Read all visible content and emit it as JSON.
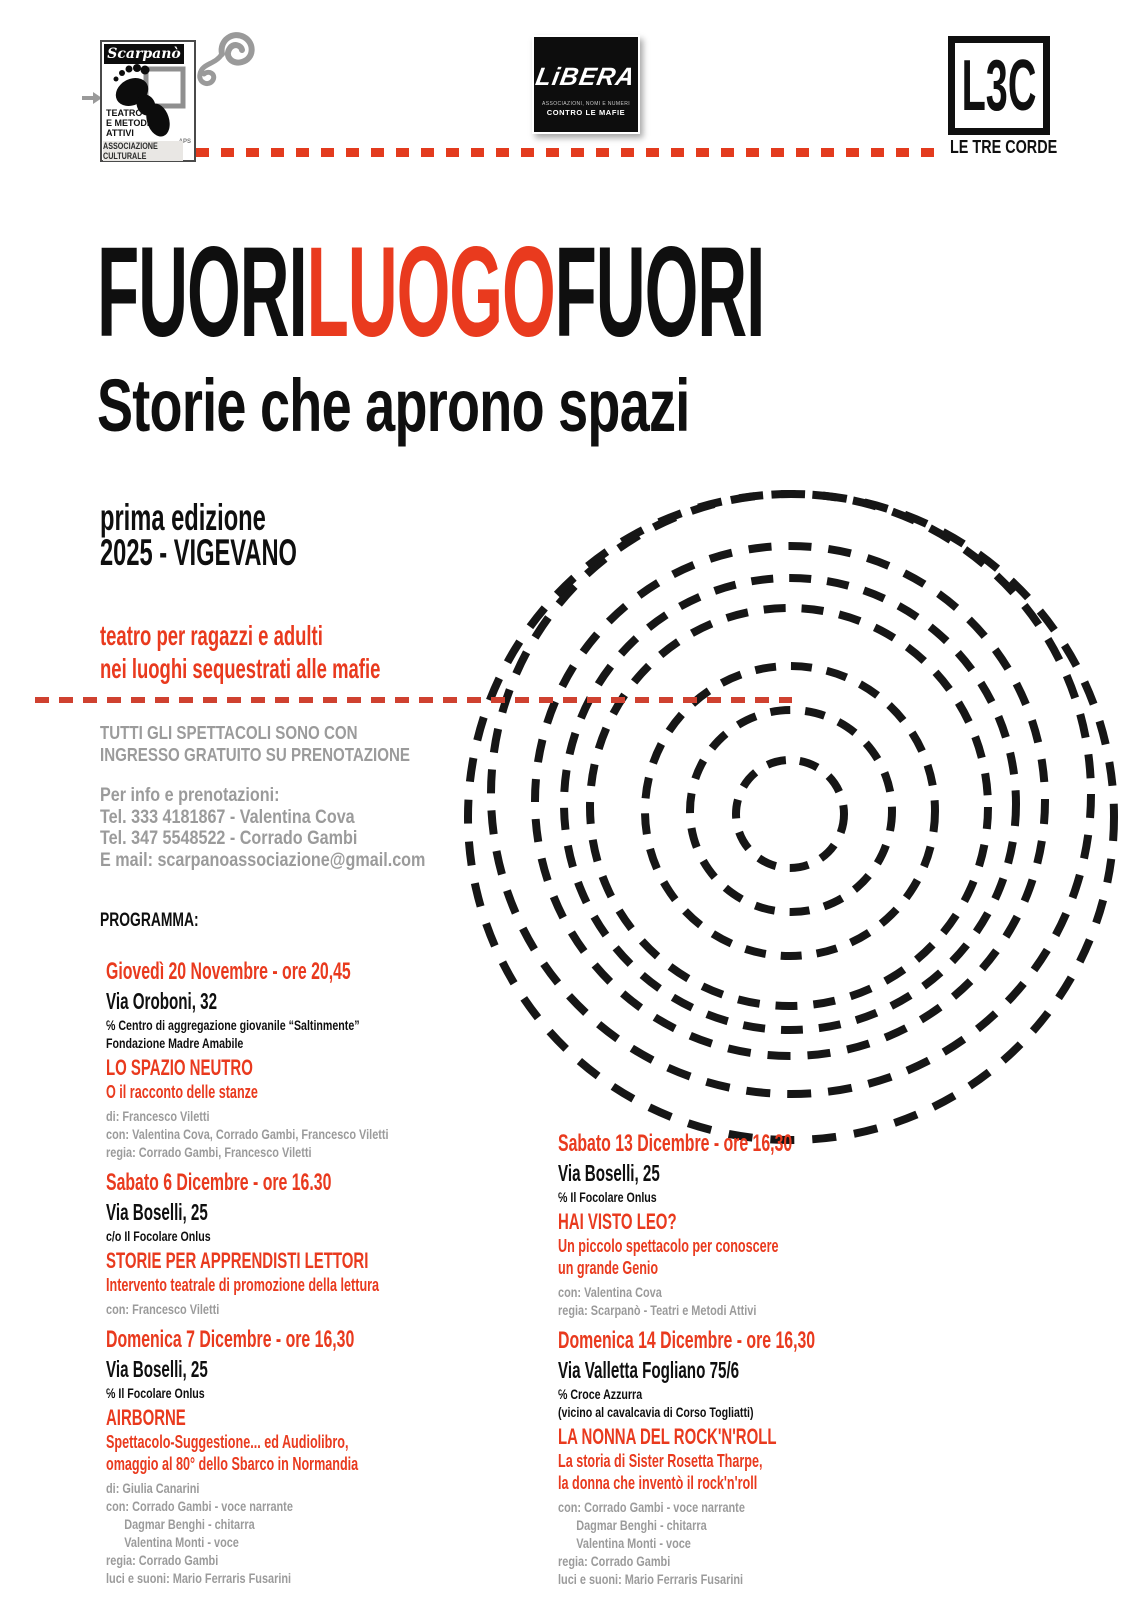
{
  "colors": {
    "accent_red": "#e93a1e",
    "text_gray": "#9b9b9b",
    "ink_black": "#0f0f0f"
  },
  "logos": {
    "scarpano": {
      "name": "Scarpanò",
      "line1": "TEATRO",
      "line2": "E METODI",
      "line3": "ATTIVI",
      "aps": "APS",
      "bottom": "ASSOCIAZIONE CULTURALE"
    },
    "libera": {
      "name": "LiBERA",
      "sub1": "ASSOCIAZIONI, NOMI E NUMERI",
      "sub2": "CONTRO LE MAFIE"
    },
    "l3c": {
      "abbr": "L3C",
      "name": "LE TRE CORDE"
    }
  },
  "title": {
    "part1": "FUORI",
    "part2": "LUOGO",
    "part3": "FUORI",
    "subtitle": "Storie che aprono spazi",
    "edition_line1": "prima edizione",
    "edition_line2": "2025 - VIGEVANO",
    "tagline_line1": "teatro per ragazzi e adulti",
    "tagline_line2": "nei luoghi sequestrati alle mafie"
  },
  "info": {
    "free_line1": "TUTTI GLI SPETTACOLI SONO CON",
    "free_line2": "INGRESSO GRATUITO SU PRENOTAZIONE",
    "contact_line1": "Per info e prenotazioni:",
    "contact_line2": "Tel. 333 4181867 - Valentina Cova",
    "contact_line3": "Tel. 347 5548522 - Corrado Gambi",
    "contact_line4": "E mail: scarpanoassociazione@gmail.com"
  },
  "program": {
    "heading": "PROGRAMMA:",
    "events": [
      {
        "column": "left",
        "date": "Giovedì 20 Novembre - ore 20,45",
        "venue": "Via Oroboni, 32",
        "location_lines": [
          "℅ Centro di aggregazione giovanile “Saltinmente”",
          "Fondazione Madre Amabile"
        ],
        "title": "LO SPAZIO NEUTRO",
        "subtitle_lines": [
          "O il racconto delle stanze"
        ],
        "credits": [
          "di: Francesco Viletti",
          "con: Valentina Cova, Corrado Gambi, Francesco Viletti",
          "regia: Corrado Gambi, Francesco Viletti"
        ]
      },
      {
        "column": "left",
        "date": "Sabato 6 Dicembre - ore 16.30",
        "venue": "Via Boselli, 25",
        "location_lines": [
          "c/o Il Focolare Onlus"
        ],
        "title": "STORIE PER APPRENDISTI LETTORI",
        "subtitle_lines": [
          "Intervento teatrale di promozione della lettura"
        ],
        "credits": [
          "con: Francesco Viletti"
        ]
      },
      {
        "column": "left",
        "date": "Domenica 7 Dicembre - ore 16,30",
        "venue": "Via Boselli, 25",
        "location_lines": [
          "℅ Il Focolare Onlus"
        ],
        "title": "AIRBORNE",
        "subtitle_lines": [
          "Spettacolo-Suggestione... ed Audiolibro,",
          "omaggio al 80° dello Sbarco in Normandia"
        ],
        "credits": [
          "di: Giulia Canarini",
          "con: Corrado Gambi - voce narrante",
          "      Dagmar Benghi - chitarra",
          "      Valentina Monti - voce",
          "regia: Corrado Gambi",
          "luci e suoni: Mario Ferraris Fusarini"
        ]
      },
      {
        "column": "right",
        "date": "Sabato 13 Dicembre - ore 16,30",
        "venue": "Via Boselli, 25",
        "location_lines": [
          "℅ Il Focolare Onlus"
        ],
        "title": "HAI VISTO LEO?",
        "subtitle_lines": [
          "Un piccolo spettacolo per conoscere",
          "un grande Genio"
        ],
        "credits": [
          "con: Valentina Cova",
          "regia: Scarpanò - Teatri e Metodi Attivi"
        ]
      },
      {
        "column": "right",
        "date": "Domenica 14 Dicembre - ore 16,30",
        "venue": "Via Valletta Fogliano 75/6",
        "location_lines": [
          "℅ Croce Azzurra",
          "(vicino al cavalcavia di Corso Togliatti)"
        ],
        "title": "LA NONNA DEL ROCK'N'ROLL",
        "subtitle_lines": [
          "La storia di Sister Rosetta Tharpe,",
          "la donna che inventò il rock'n'roll"
        ],
        "credits": [
          "con: Corrado Gambi - voce narrante",
          "      Dagmar Benghi - chitarra",
          "      Valentina Monti - voce",
          "regia: Corrado Gambi",
          "luci e suoni: Mario Ferraris Fusarini"
        ]
      }
    ]
  }
}
